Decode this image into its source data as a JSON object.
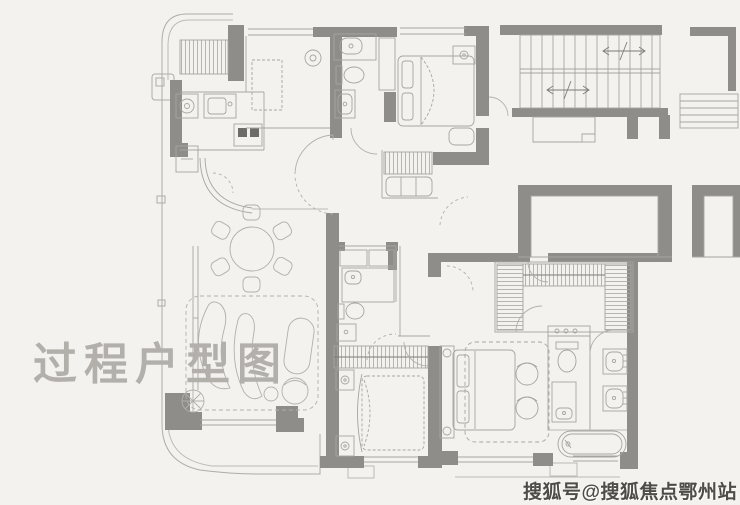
{
  "watermarks": {
    "process": "过程户型图",
    "source": "搜狐号@搜狐焦点鄂州站"
  },
  "palette": {
    "background": "#f4f2ef",
    "wall_fill": "#8f8d89",
    "line": "#a7a5a1",
    "furniture_line": "#b2b0ac",
    "burner_dark": "#6e6c68",
    "watermark_light": "#b3b0ac",
    "watermark_dark": "#4f4c48"
  },
  "plan": {
    "type": "residential-floor-plan",
    "elements": [
      "equipment-platform",
      "kitchen-counter",
      "kitchen-sink",
      "gas-stove",
      "kitchen-island",
      "powder-room-toilet",
      "powder-room-vanity",
      "bedroom-bed",
      "bedside-table",
      "wardrobe",
      "staircase",
      "stair-direction-arrows",
      "light-well",
      "dining-table-six-chairs",
      "living-room-rug",
      "curved-sofa",
      "armchair",
      "floor-lamp",
      "guest-bathroom-shower",
      "guest-bathroom-toilet",
      "second-bedroom-bed",
      "walk-in-closet",
      "water-closet",
      "double-vanity",
      "bathtub",
      "master-bedroom-bed",
      "balcony",
      "windows",
      "door-swings"
    ]
  }
}
